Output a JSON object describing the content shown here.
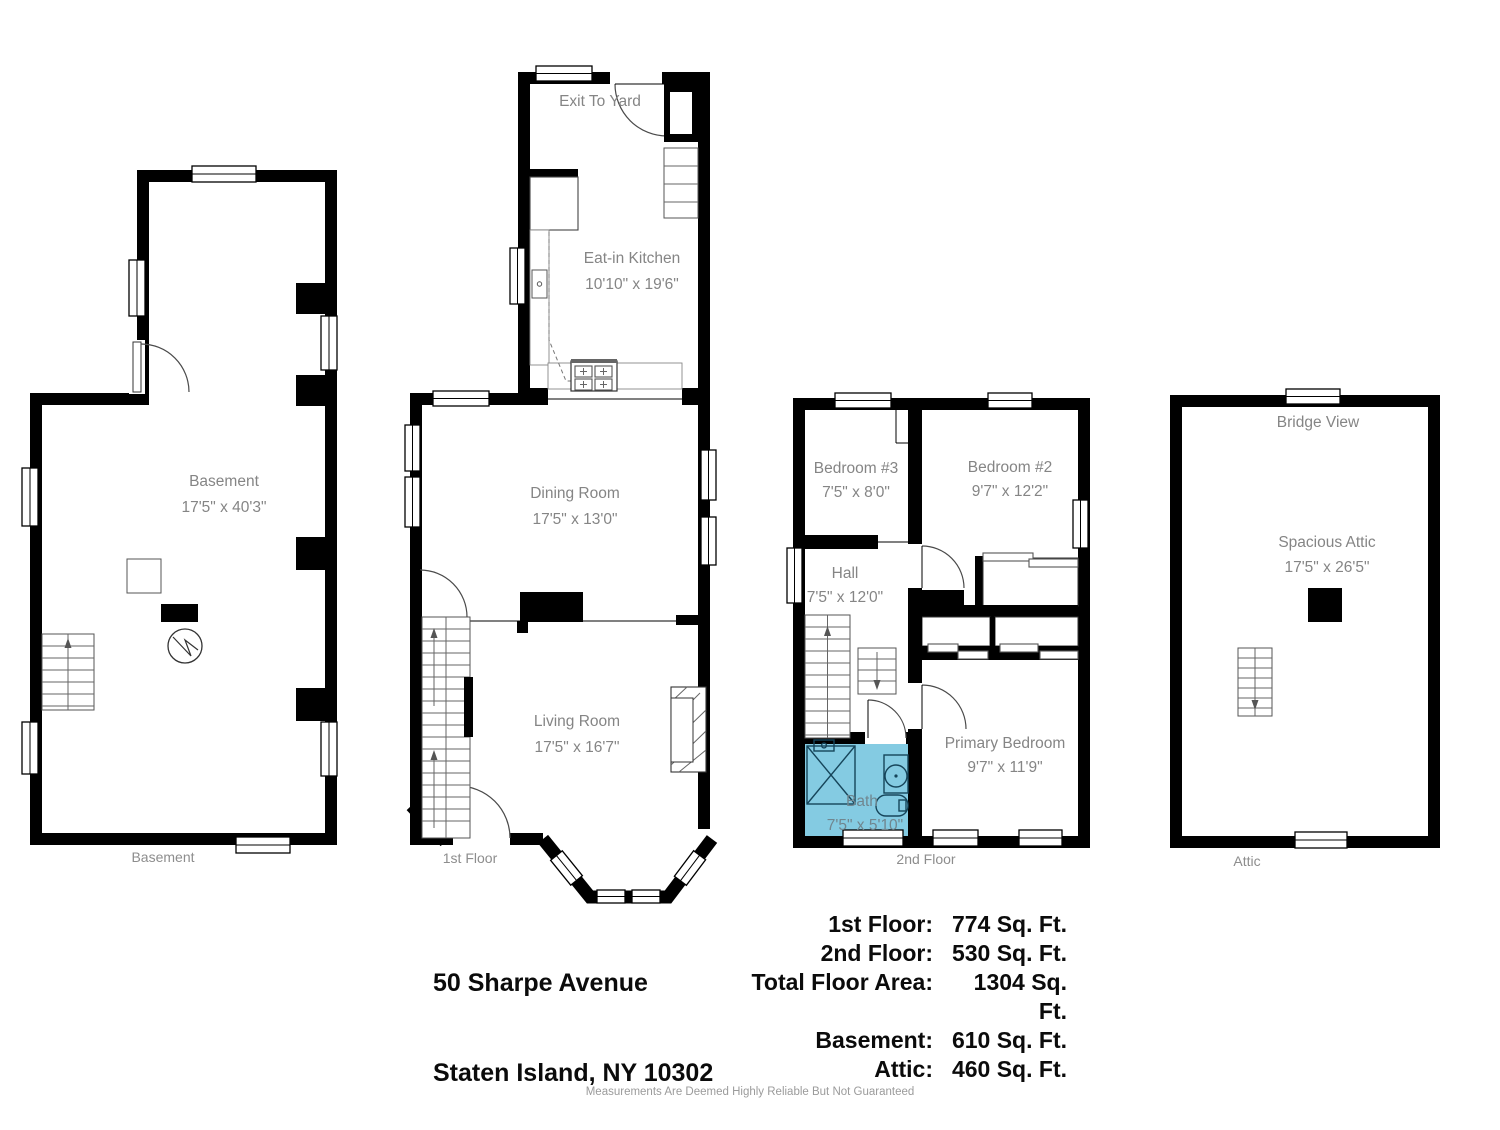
{
  "colors": {
    "wall": "#000000",
    "bath_fill": "#84cbe2",
    "room_text": "#858585"
  },
  "address": {
    "line1": "50 Sharpe Avenue",
    "line2": "Staten Island, NY 10302"
  },
  "area_table": {
    "rows": [
      {
        "label": "1st Floor:",
        "value": "774 Sq. Ft."
      },
      {
        "label": "2nd Floor:",
        "value": "530 Sq. Ft."
      },
      {
        "label": "Total Floor Area:",
        "value": "1304 Sq. Ft."
      },
      {
        "label": "Basement:",
        "value": "610 Sq. Ft."
      },
      {
        "label": "Attic:",
        "value": "460 Sq. Ft."
      }
    ]
  },
  "disclaimer": "Measurements Are Deemed Highly Reliable But Not Guaranteed",
  "plans": {
    "basement": {
      "floor_label": "Basement",
      "room": {
        "name": "Basement",
        "dims": "17'5\" x 40'3\""
      }
    },
    "first_floor": {
      "floor_label": "1st Floor",
      "exit_note": "Exit To Yard",
      "rooms": {
        "kitchen": {
          "name": "Eat-in Kitchen",
          "dims": "10'10\" x 19'6\""
        },
        "dining": {
          "name": "Dining Room",
          "dims": "17'5\" x 13'0\""
        },
        "living": {
          "name": "Living Room",
          "dims": "17'5\" x 16'7\""
        }
      }
    },
    "second_floor": {
      "floor_label": "2nd Floor",
      "rooms": {
        "bedroom3": {
          "name": "Bedroom #3",
          "dims": "7'5\" x 8'0\""
        },
        "bedroom2": {
          "name": "Bedroom #2",
          "dims": "9'7\" x 12'2\""
        },
        "hall": {
          "name": "Hall",
          "dims": "7'5\" x 12'0\""
        },
        "primary": {
          "name": "Primary Bedroom",
          "dims": "9'7\" x 11'9\""
        },
        "bath": {
          "name": "Bath",
          "dims": "7'5\" x 5'10\""
        }
      }
    },
    "attic": {
      "floor_label": "Attic",
      "view_note": "Bridge View",
      "room": {
        "name": "Spacious Attic",
        "dims": "17'5\" x 26'5\""
      }
    }
  }
}
